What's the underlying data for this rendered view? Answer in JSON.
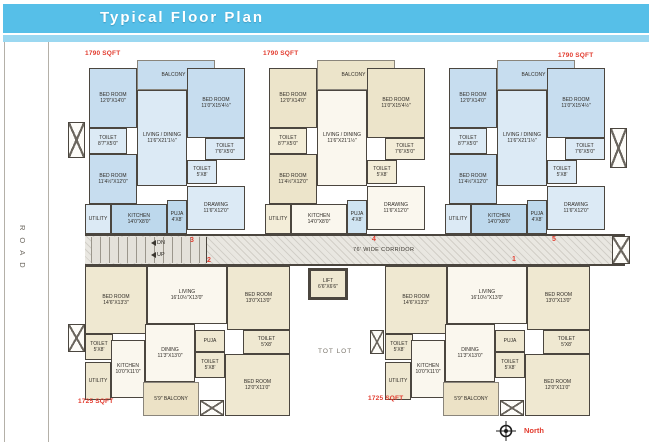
{
  "header": {
    "title": "Typical Floor Plan"
  },
  "road": {
    "label": "ROAD"
  },
  "plan": {
    "corridor": {
      "label": "76' WIDE CORRIDOR",
      "down_label": "DN",
      "up_label": "UP"
    },
    "lift": {
      "name": "LIFT",
      "dims": "6'6\"X6'6\""
    },
    "tot_lot": {
      "label": "TOT LOT"
    },
    "compass": {
      "label": "North"
    },
    "unit_numbers": {
      "u1": "1",
      "u2": "2",
      "u3": "3",
      "u4": "4",
      "u5": "5"
    },
    "top_unit": {
      "sqft": "1790 SQFT",
      "rooms": {
        "balcony": {
          "name": "BALCONY 7'"
        },
        "bed1": {
          "name": "BED ROOM",
          "dims": "12'0\"X14'0\""
        },
        "bed2": {
          "name": "BED ROOM",
          "dims": "11'0\"X15'4½\""
        },
        "bed3": {
          "name": "BED ROOM",
          "dims": "11'4½\"X12'0\""
        },
        "toilet1": {
          "name": "TOILET",
          "dims": "8'7\"X5'0\""
        },
        "toilet2": {
          "name": "TOILET",
          "dims": "7'6\"X5'0\""
        },
        "toilet3": {
          "name": "TOILET",
          "dims": "5'X8'"
        },
        "living": {
          "name": "LIVING / DINING",
          "dims": "11'6\"X21'1½\""
        },
        "kitchen": {
          "name": "KITCHEN",
          "dims": "14'0\"X8'0\""
        },
        "utility": {
          "name": "UTILITY"
        },
        "puja": {
          "name": "PUJA",
          "dims": "4'X8'"
        },
        "drawing": {
          "name": "DRAWING",
          "dims": "11'6\"X12'0\""
        }
      }
    },
    "bottom_unit": {
      "sqft": "1725 SQFT",
      "rooms": {
        "bed1": {
          "name": "BED ROOM",
          "dims": "14'6\"X13'3\""
        },
        "living": {
          "name": "LIVING",
          "dims": "16'10½\"X13'0\""
        },
        "bed2": {
          "name": "BED ROOM",
          "dims": "13'0\"X13'0\""
        },
        "bed3": {
          "name": "BED ROOM",
          "dims": "12'0\"X11'0\""
        },
        "toilet": {
          "name": "TOILET",
          "dims": "5'X8'"
        },
        "dining": {
          "name": "DINING",
          "dims": "11'3\"X13'0\""
        },
        "kitchen": {
          "name": "KITCHEN",
          "dims": "10'0\"X11'0\""
        },
        "utility": {
          "name": "UTILITY"
        },
        "puja": {
          "name": "PUJA"
        },
        "balcony": {
          "name": "5'9\" BALCONY"
        }
      }
    },
    "colors": {
      "header_blue": "#56bfe8",
      "accent_red": "#e23b2e",
      "wall": "#4b463f",
      "blue_room": "#c7ddef",
      "cream_room": "#f3edd8"
    }
  }
}
